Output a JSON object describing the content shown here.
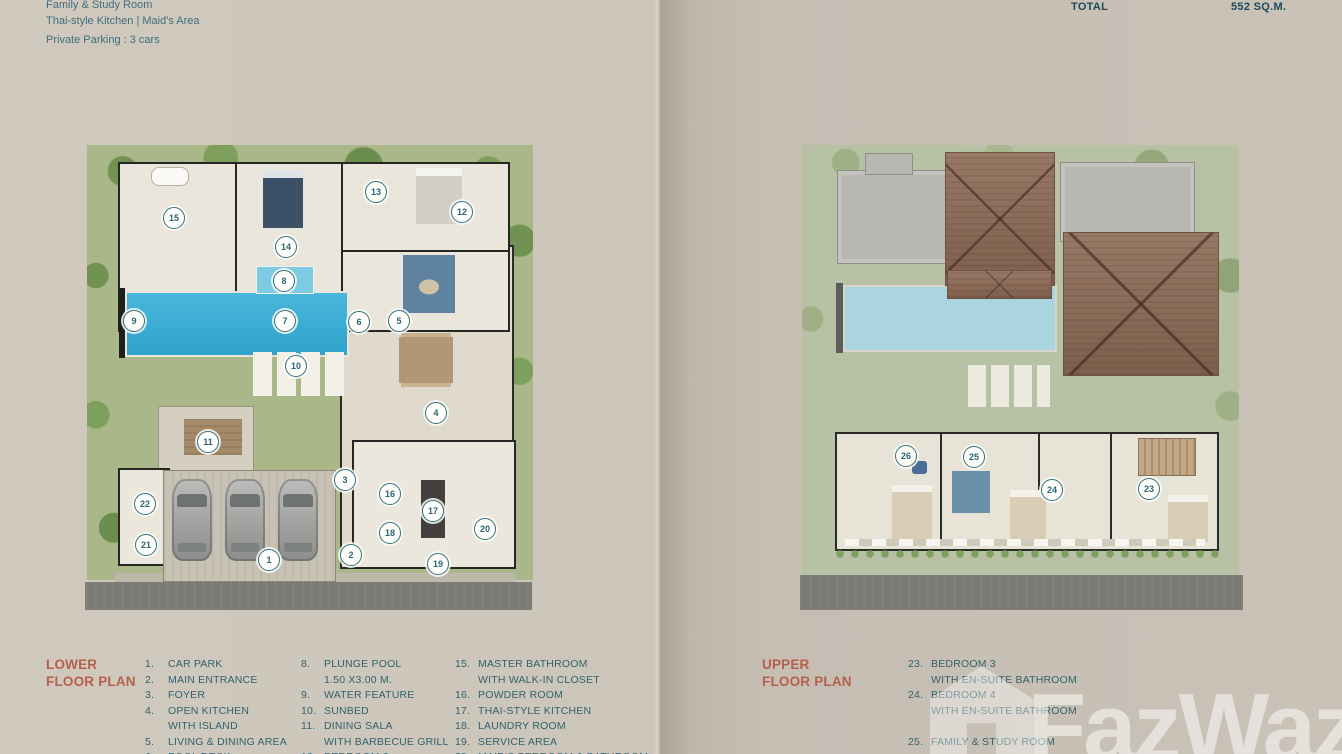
{
  "header": {
    "left_lines": {
      "line1": "Family & Study Room",
      "line2": "Thai-style Kitchen  |  Maid's Area",
      "line3": "Private Parking : 3 cars"
    },
    "right": {
      "total_label": "TOTAL",
      "total_value": "552 SQ.M."
    }
  },
  "lower_plan": {
    "title_line1": "LOWER",
    "title_line2": "FLOOR PLAN",
    "markers": [
      {
        "n": "1",
        "x": 268,
        "y": 559
      },
      {
        "n": "2",
        "x": 350,
        "y": 554
      },
      {
        "n": "3",
        "x": 344,
        "y": 479
      },
      {
        "n": "4",
        "x": 435,
        "y": 412
      },
      {
        "n": "5",
        "x": 398,
        "y": 320
      },
      {
        "n": "6",
        "x": 358,
        "y": 321
      },
      {
        "n": "7",
        "x": 284,
        "y": 320
      },
      {
        "n": "8",
        "x": 283,
        "y": 280
      },
      {
        "n": "9",
        "x": 133,
        "y": 320
      },
      {
        "n": "10",
        "x": 295,
        "y": 365
      },
      {
        "n": "11",
        "x": 207,
        "y": 441
      },
      {
        "n": "12",
        "x": 461,
        "y": 211
      },
      {
        "n": "13",
        "x": 375,
        "y": 191
      },
      {
        "n": "14",
        "x": 285,
        "y": 246
      },
      {
        "n": "15",
        "x": 173,
        "y": 217
      },
      {
        "n": "16",
        "x": 389,
        "y": 493
      },
      {
        "n": "17",
        "x": 432,
        "y": 510
      },
      {
        "n": "18",
        "x": 389,
        "y": 532
      },
      {
        "n": "19",
        "x": 437,
        "y": 563
      },
      {
        "n": "20",
        "x": 484,
        "y": 528
      },
      {
        "n": "21",
        "x": 145,
        "y": 544
      },
      {
        "n": "22",
        "x": 144,
        "y": 503
      }
    ],
    "legend_columns": [
      [
        {
          "n": "1.",
          "lines": [
            "CAR PARK"
          ]
        },
        {
          "n": "2.",
          "lines": [
            "MAIN ENTRANCE"
          ]
        },
        {
          "n": "3.",
          "lines": [
            "FOYER"
          ]
        },
        {
          "n": "4.",
          "lines": [
            "OPEN KITCHEN",
            "WITH ISLAND"
          ]
        },
        {
          "n": "5.",
          "lines": [
            "LIVING & DINING AREA"
          ]
        },
        {
          "n": "6.",
          "lines": [
            "POOL DECK"
          ]
        }
      ],
      [
        {
          "n": "8.",
          "lines": [
            "PLUNGE POOL",
            "1.50 X3.00 M."
          ]
        },
        {
          "n": "9.",
          "lines": [
            "WATER FEATURE"
          ]
        },
        {
          "n": "10.",
          "lines": [
            "SUNBED"
          ]
        },
        {
          "n": "11.",
          "lines": [
            "DINING SALA",
            "WITH BARBECUE GRILL"
          ]
        },
        {
          "n": "12.",
          "lines": [
            "BEDROOM 2"
          ]
        }
      ],
      [
        {
          "n": "15.",
          "lines": [
            "MASTER BATHROOM",
            "WITH WALK-IN CLOSET"
          ]
        },
        {
          "n": "16.",
          "lines": [
            "POWDER ROOM"
          ]
        },
        {
          "n": "17.",
          "lines": [
            "THAI-STYLE KITCHEN"
          ]
        },
        {
          "n": "18.",
          "lines": [
            "LAUNDRY ROOM"
          ]
        },
        {
          "n": "19.",
          "lines": [
            "SERVICE AREA"
          ]
        },
        {
          "n": "20.",
          "lines": [
            "MAID'S BEDROOM & BATHROOM"
          ]
        }
      ]
    ]
  },
  "upper_plan": {
    "title_line1": "UPPER",
    "title_line2": "FLOOR PLAN",
    "markers": [
      {
        "n": "23",
        "x": 1148,
        "y": 488
      },
      {
        "n": "24",
        "x": 1051,
        "y": 489
      },
      {
        "n": "25",
        "x": 973,
        "y": 456
      },
      {
        "n": "26",
        "x": 905,
        "y": 455
      }
    ],
    "legend_column": [
      {
        "n": "23.",
        "lines": [
          "BEDROOM 3",
          "WITH EN-SUITE BATHROOM"
        ]
      },
      {
        "n": "24.",
        "lines": [
          "BEDROOM 4",
          "WITH EN-SUITE BATHROOM"
        ]
      },
      {
        "n": "",
        "lines": [
          ""
        ]
      },
      {
        "n": "25.",
        "lines": [
          "FAMILY & STUDY ROOM"
        ]
      }
    ]
  },
  "watermark": {
    "text": "FazWaz"
  },
  "colors": {
    "header_teal": "#3f6e7e",
    "total_dark": "#1d4a5e",
    "legend_text": "#31626f",
    "title_red": "#b5604d",
    "marker_teal": "#2c6575",
    "pool_blue_lower": "#3fb0d8",
    "pool_blue_upper": "#abd4e1",
    "roof_brown": "#8d6a55",
    "garden_green": "#a9b789",
    "road_gray": "#7b7a75",
    "page_beige": "#cbc4b8"
  }
}
